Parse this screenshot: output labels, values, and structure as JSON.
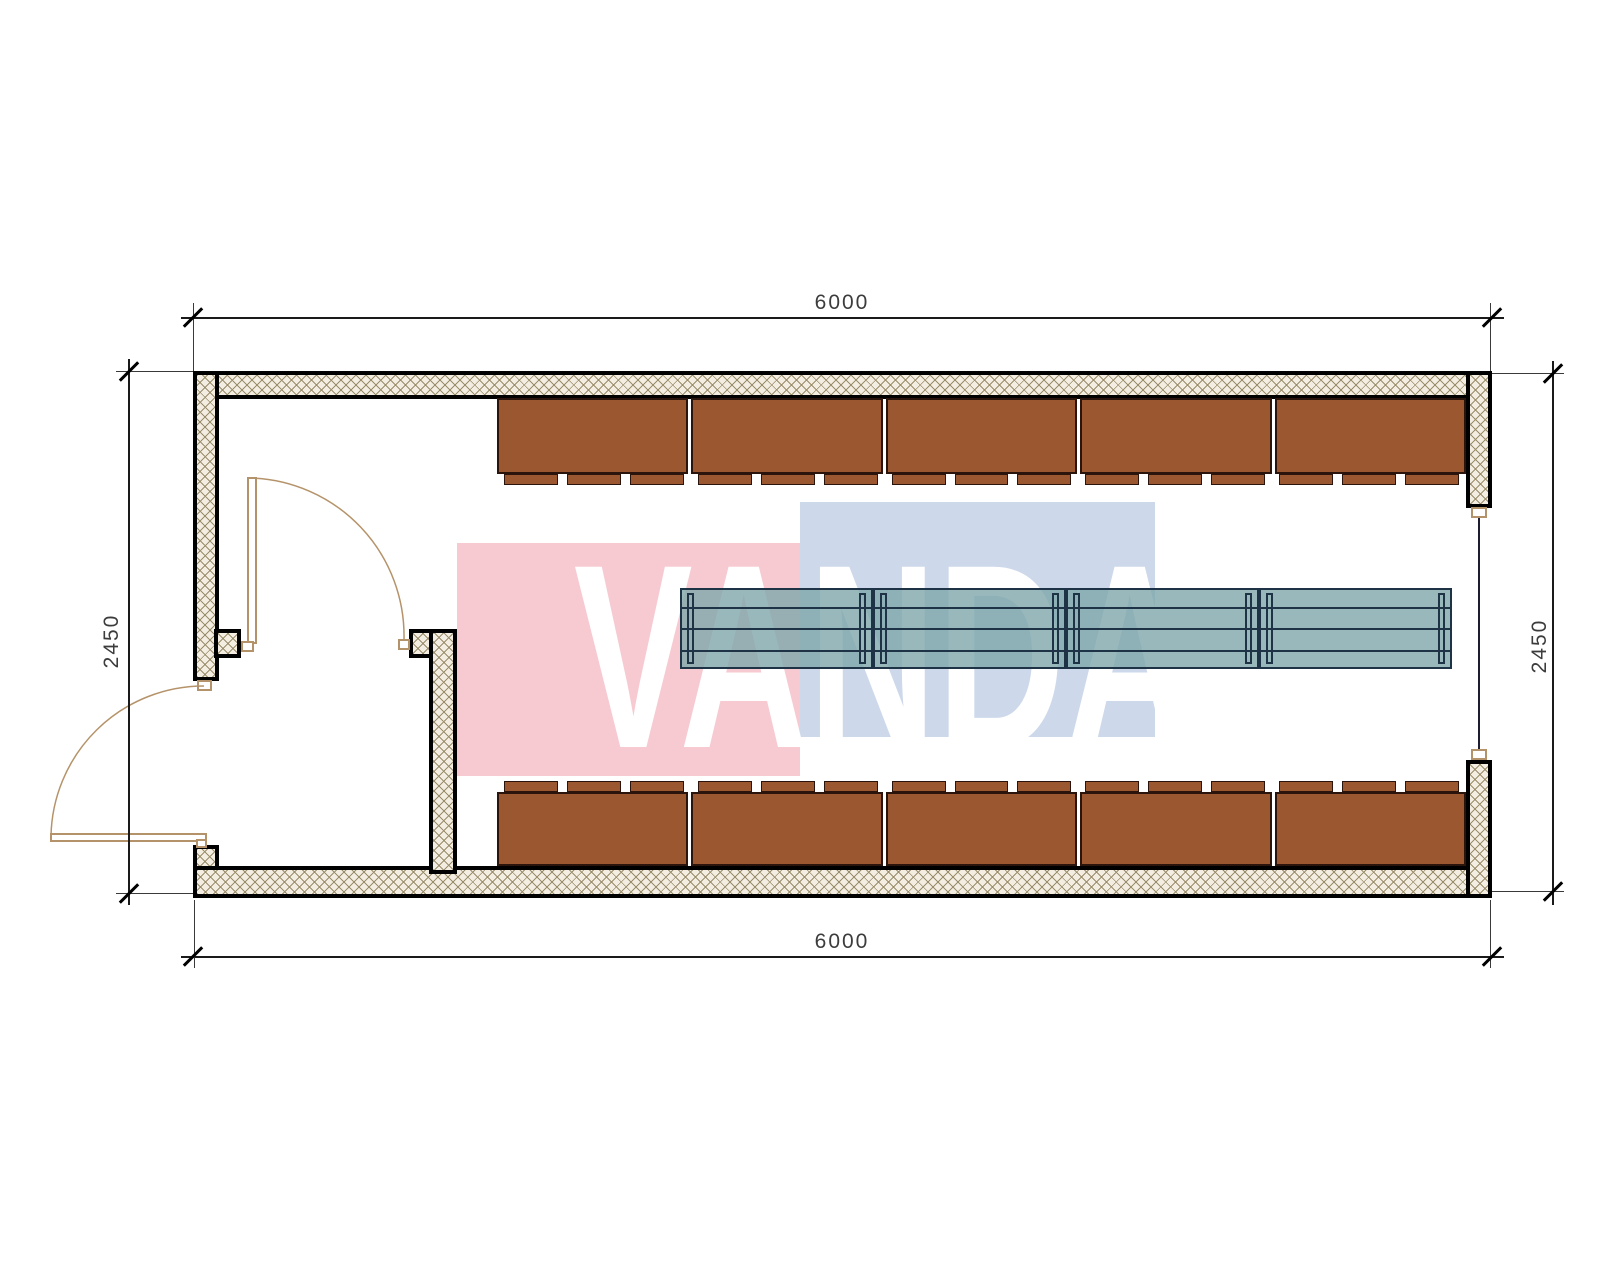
{
  "plan": {
    "type": "container-floor-plan",
    "dimensions": {
      "top": "6000",
      "bottom": "6000",
      "left": "2450",
      "right": "2450"
    },
    "watermark": {
      "text": "VANDA",
      "pink_block": "#f7cad2",
      "blue_block": "#cdd9eb",
      "text_color": "#ffffff"
    },
    "palette": {
      "wall_hatch_bg": "#f3eee1",
      "wall_hatch_line": "#9a8d6c",
      "wall_outline": "#000000",
      "cabinet_fill": "#9a5730",
      "cabinet_border": "#2b140b",
      "table_fill": "rgba(126,166,171,0.8)",
      "table_line": "#1f3347",
      "door_line": "#b5936a",
      "dimension_line": "#1a1a1a"
    },
    "furniture": {
      "top_cabinet_units": 5,
      "bottom_cabinet_units": 5,
      "tabs_per_unit": 3,
      "table_units": 4
    }
  }
}
